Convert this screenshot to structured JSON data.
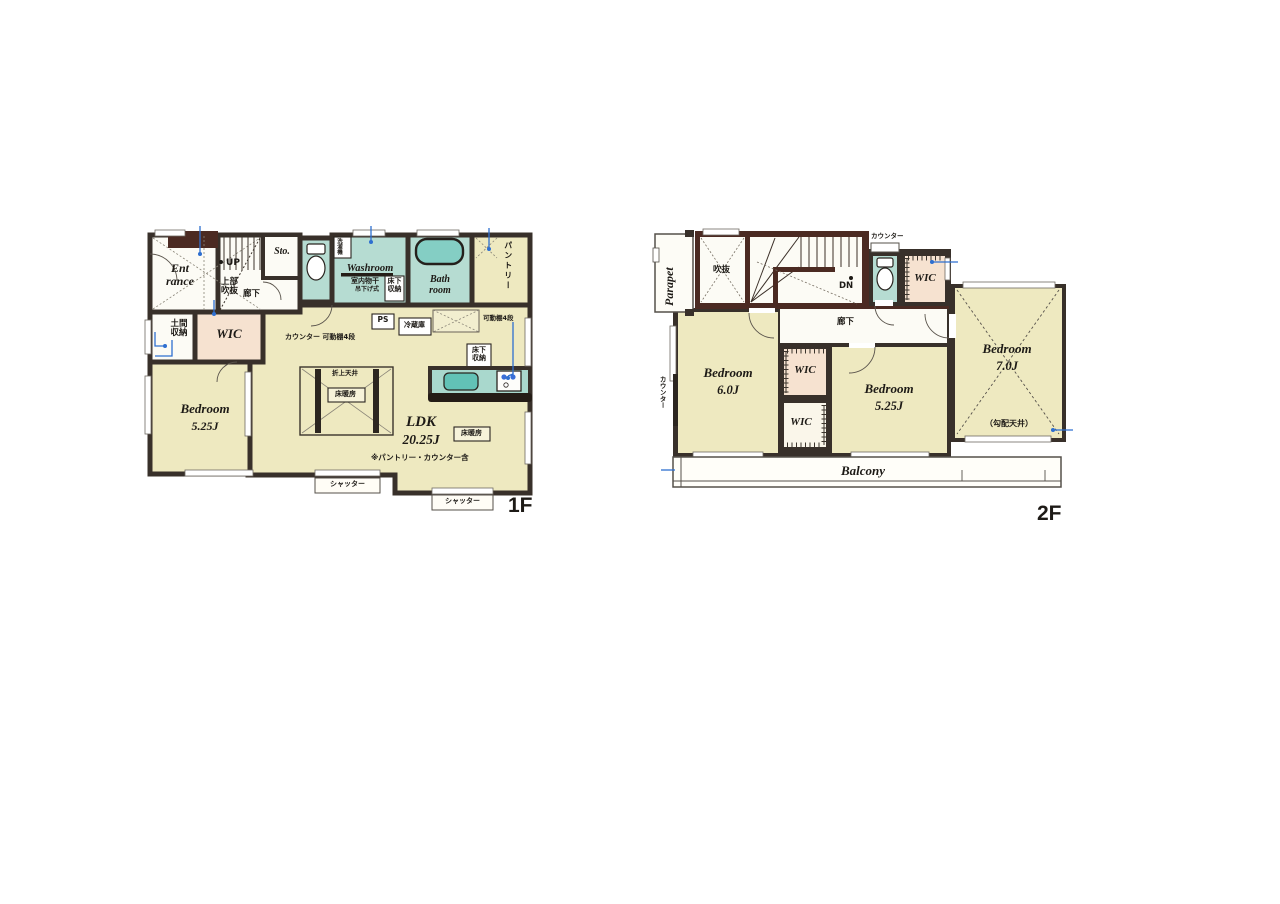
{
  "meta": {
    "colors": {
      "wall": "#38302a",
      "wall_accent": "#4b2a22",
      "room_cream": "#eee9c0",
      "room_wet": "#b6dcd2",
      "room_closet": "#f6e2d0",
      "tub": "#84cec4",
      "marker_blue": "#2e6fd0"
    }
  },
  "f1": {
    "floor": "1F",
    "entrance": "Ent rance",
    "up": "UP",
    "upper_void": "上部吹抜",
    "hallway": "廊下",
    "storage": "Sto.",
    "washroom": "Washroom",
    "washing_machine": "洗濯機",
    "indoor_drying": "室内物干",
    "hanging_type": "吊下げ式",
    "underfloor_storage_wash": "床下収納",
    "bathroom": "Bath room",
    "pantry": "パントリー",
    "doma_storage": "土間収納",
    "wic": "WIC",
    "counter_shelf": "カウンター 可動棚4段",
    "ps": "PS",
    "fridge": "冷蔵庫",
    "movable_shelf": "可動棚4段",
    "underfloor_storage_kitchen": "床下収納",
    "coffered_ceiling": "折上天井",
    "floor_heating_center": "床暖房",
    "floor_heating_right": "床暖房",
    "bedroom_name": "Bedroom",
    "bedroom_size": "5.25J",
    "ldk_name": "LDK",
    "ldk_size": "20.25J",
    "note": "※パントリー・カウンター含",
    "shutter_left": "シャッター",
    "shutter_right": "シャッター"
  },
  "f2": {
    "floor": "2F",
    "parapet": "Parapet",
    "void": "吹抜",
    "dn": "DN",
    "counter_top": "カウンター",
    "counter_left": "カウンター",
    "hallway": "廊下",
    "wic_top": "WIC",
    "wic_mid": "WIC",
    "wic_low": "WIC",
    "bedroom6_name": "Bedroom",
    "bedroom6_size": "6.0J",
    "bedroom525_name": "Bedroom",
    "bedroom525_size": "5.25J",
    "bedroom7_name": "Bedroom",
    "bedroom7_size": "7.0J",
    "sloped_ceiling": "（勾配天井）",
    "balcony": "Balcony"
  }
}
